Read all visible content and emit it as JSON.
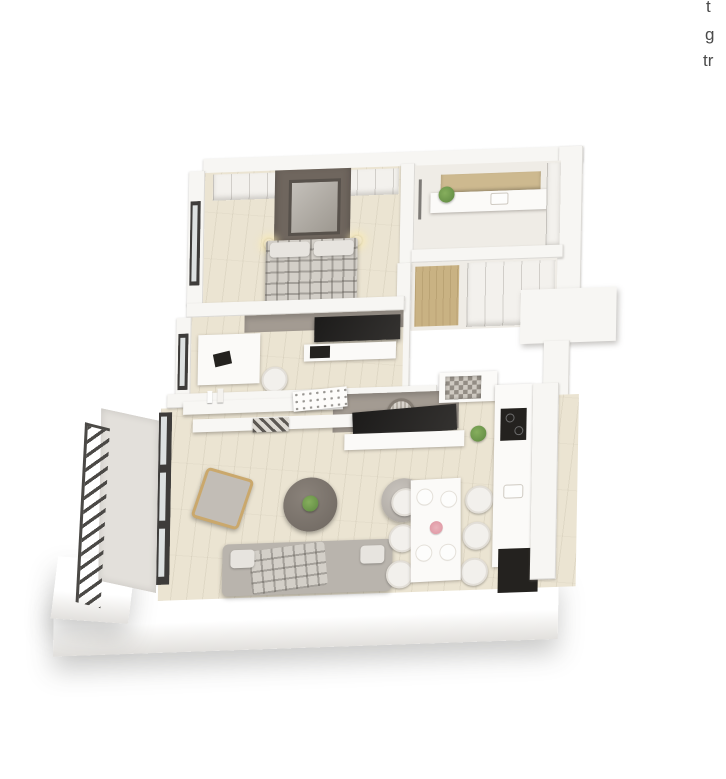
{
  "page": {
    "background": "#ffffff",
    "width": 726,
    "height": 779
  },
  "clipped_text": {
    "description": "paragraph text cut off at the right edge of the screenshot",
    "line1": "t",
    "line2": "g",
    "line3": "tr",
    "color": "#4a4a4a"
  },
  "floorplan": {
    "view": "3d-isometric-apartment-render",
    "palette": {
      "background": "#ffffff",
      "slab_white": "#f7f6f3",
      "floor_wood": "#ebe4d2",
      "hall_mat_wood": "#c9b283",
      "interior_gray_wall": "#a39b92",
      "accent_dark_panel": "#6f665e",
      "furniture_dark": "#24221f",
      "textile_gray": "#b9b4ad",
      "plant_green": "#5d8740",
      "railing_dark": "#4b4946",
      "flowers_pink": "#e8a7b0"
    },
    "rooms": [
      {
        "name": "bedroom",
        "items": [
          "wardrobe",
          "double-bed-plaid",
          "accent-wall-panel",
          "framed-art",
          "wall-sconces",
          "window"
        ]
      },
      {
        "name": "bathroom",
        "items": [
          "shower",
          "vanity-sink",
          "wood-counter",
          "hanging-plant",
          "wall-cabinet"
        ]
      },
      {
        "name": "hallway",
        "items": [
          "wood-runner-mat",
          "closet"
        ]
      },
      {
        "name": "office",
        "items": [
          "corner-desk",
          "desk-chair",
          "laptop",
          "wall-tv",
          "media-console",
          "window"
        ]
      },
      {
        "name": "living-room",
        "items": [
          "wall-shelves",
          "decor-vases",
          "dot-print-frame",
          "plaid-textiles",
          "tv",
          "tv-console",
          "wall-clock",
          "plant-side-table",
          "armchair",
          "round-coffee-table",
          "pouf",
          "plaid-sofa",
          "balcony-doors"
        ]
      },
      {
        "name": "balcony",
        "items": [
          "metal-railing"
        ]
      },
      {
        "name": "kitchen",
        "items": [
          "mosaic-peninsula",
          "counter-run",
          "cooktop",
          "sink",
          "tall-dark-appliance"
        ]
      },
      {
        "name": "dining-area",
        "items": [
          "white-table",
          "six-chairs",
          "plates",
          "pink-flower-centerpiece"
        ]
      }
    ]
  }
}
